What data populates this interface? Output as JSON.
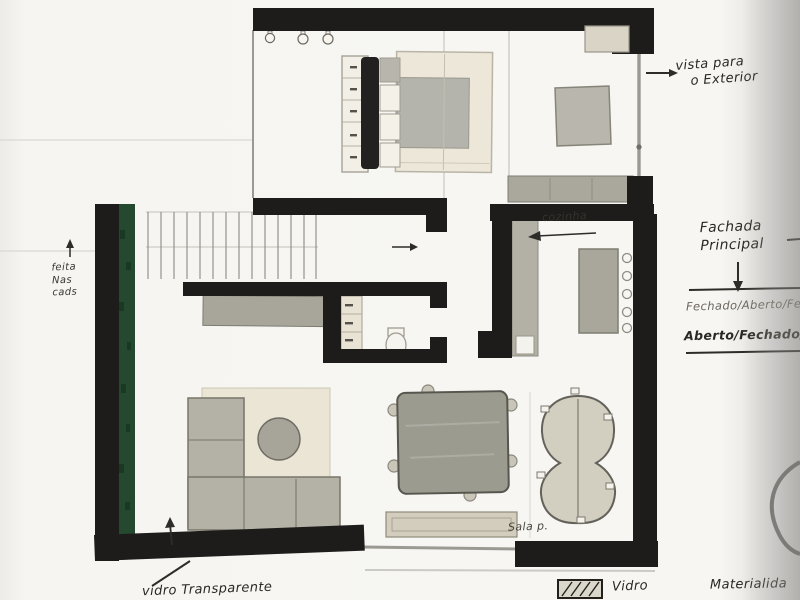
{
  "annotations": {
    "vista_exterior": {
      "line1": "vista para",
      "line2": "o Exterior"
    },
    "fachada_principal": {
      "line1": "Fachada",
      "line2": "Principal"
    },
    "estados": {
      "line1": "Fechado/Aberto/Fe",
      "line2": "Aberto/Fechado/Ab"
    },
    "cozinha_label": "cozinha",
    "sala_label": "Sala p.",
    "left_note": {
      "line1": "feita",
      "line2": "Nas",
      "line3": "cads"
    },
    "vidro_transparente_label": "vidro Transparente",
    "legend": {
      "vidro": "Vidro",
      "materialidade": "Materialida"
    }
  },
  "colors": {
    "paper": "#f5f4f1",
    "wall": "#1d1c1a",
    "plant-green": "#24492f",
    "glass": "#9a9a92",
    "furn-gray": "#aaa89d",
    "furn-cream": "#ece7d9",
    "ink": "#2b2823"
  }
}
